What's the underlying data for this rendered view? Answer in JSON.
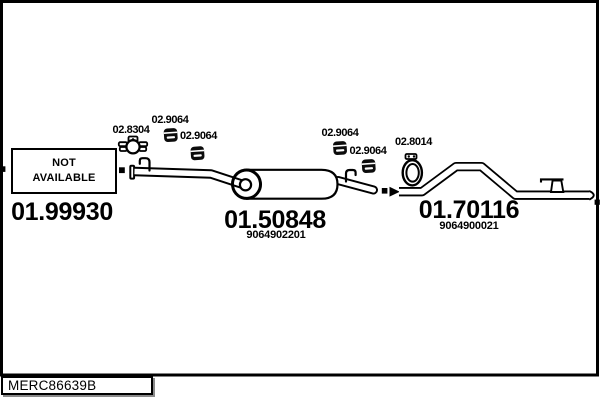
{
  "colors": {
    "ink": "#000000",
    "paper": "#ffffff",
    "shadow": "#8a8a8a"
  },
  "footer": {
    "drawing_code": "MERC86639B"
  },
  "front_section": {
    "part_number": "01.99930",
    "availability": {
      "line1": "NOT",
      "line2": "AVAILABLE"
    }
  },
  "middle_section": {
    "part_number": "01.50848",
    "oe_number": "9064902201"
  },
  "rear_section": {
    "part_number": "01.70116",
    "oe_number": "9064900021"
  },
  "fittings": {
    "clamp_front": {
      "part_number": "02.8304"
    },
    "hanger_1": {
      "part_number": "02.9064"
    },
    "hanger_2": {
      "part_number": "02.9064"
    },
    "hanger_3": {
      "part_number": "02.9064"
    },
    "hanger_4": {
      "part_number": "02.9064"
    },
    "clamp_rear": {
      "part_number": "02.8014"
    }
  }
}
